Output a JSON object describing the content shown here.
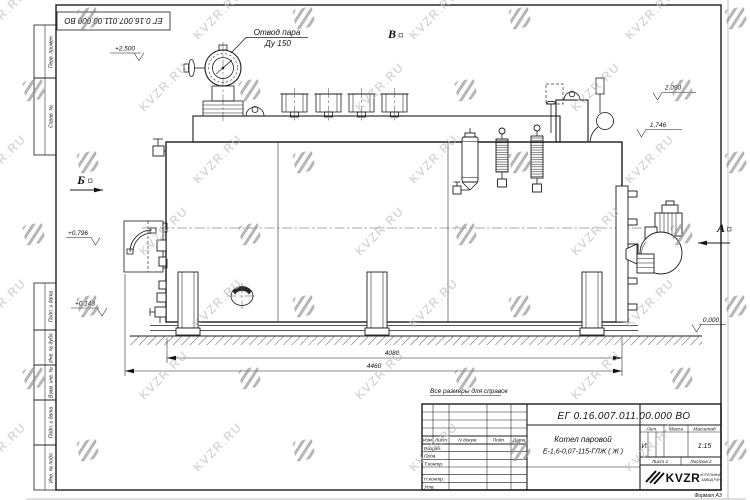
{
  "watermark": {
    "text": "KVZR.RU",
    "text_color": "#bdbdbd",
    "logo_color": "#8f8f8f",
    "cols": 8,
    "rows": 7,
    "dx": 108,
    "dy": 72,
    "x0": -30,
    "y0": 8,
    "stagger": 54
  },
  "sheet": {
    "format_note": "Формат А3",
    "reference_note": "Все размеры для справок"
  },
  "margin_columns": [
    "Перв. примен.",
    "Справ. №",
    "Подп. и дата",
    "Инв. № дубл.",
    "Взам. инв. №",
    "Подп. и дата",
    "Инв. № подл."
  ],
  "title_block": {
    "doc_number": "ЕГ 0.16.007.011.00.000  ВО",
    "header_cells": [
      "Изм",
      "Лист",
      "N докум.",
      "Подп.",
      "Дата"
    ],
    "row_labels": [
      "Разраб.",
      "Пров.",
      "Т.контр.",
      "Н.контр.",
      "Утв."
    ],
    "product_line1": "Котел паровой",
    "product_line2": "Е-1,6-0,07-115-ГЛЖ ( Ж )",
    "lit_header": "Лит.",
    "mass_header": "Масса",
    "scale_header": "Масштаб",
    "lit_value": "И",
    "scale_value": "1:15",
    "sheet_count": "Лист 1",
    "sheets_total": "Листов 2",
    "logo_text": "KVZR",
    "logo_caption1": "КОТЕЛЬНЫЙ",
    "logo_caption2": "ЗАВОД РЭН"
  },
  "drawing": {
    "callout_line1": "Отвод пара",
    "callout_line2": "Ду 150",
    "view_b": "Б",
    "view_v": "В",
    "view_a": "А",
    "levels": {
      "l2500": "+2,500",
      "l2090": "2,090",
      "l1746": "1,746",
      "l0796": "+0,796",
      "l0143": "+0,143",
      "l0000": "0,000"
    },
    "dims": {
      "d4080": "4080",
      "d4460": "4460"
    }
  }
}
